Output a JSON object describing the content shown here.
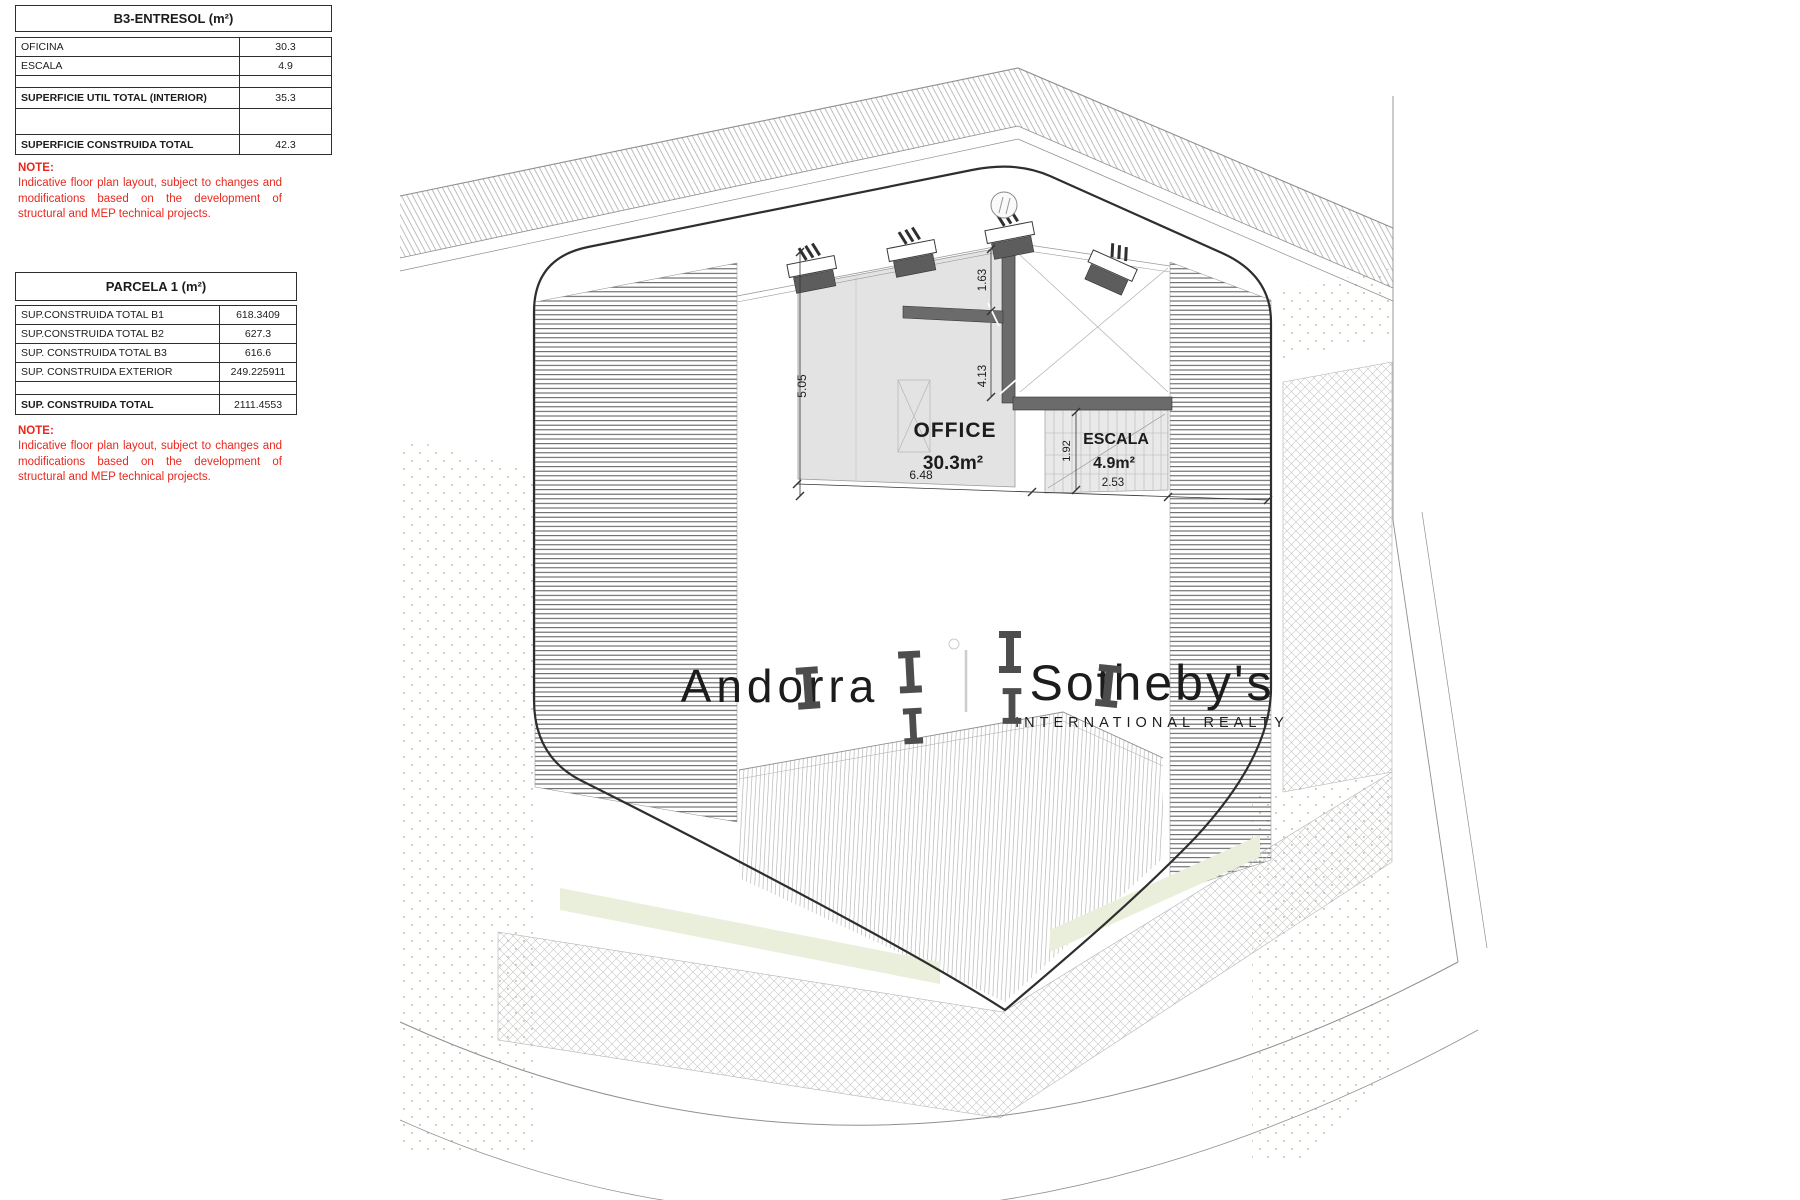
{
  "tables": {
    "b3_entresol": {
      "title": "B3-ENTRESOL (m²)",
      "rows": [
        {
          "label": "OFICINA",
          "value": "30.3"
        },
        {
          "label": "ESCALA",
          "value": "4.9"
        },
        {
          "label": "",
          "value": ""
        },
        {
          "label": "SUPERFICIE UTIL TOTAL (INTERIOR)",
          "value": "35.3"
        },
        {
          "label": "",
          "value": ""
        },
        {
          "label": "SUPERFICIE CONSTRUIDA TOTAL",
          "value": "42.3"
        }
      ]
    },
    "parcela1": {
      "title": "PARCELA 1 (m²)",
      "rows": [
        {
          "label": "SUP.CONSTRUIDA TOTAL B1",
          "value": "618.3409"
        },
        {
          "label": "SUP.CONSTRUIDA TOTAL B2",
          "value": "627.3"
        },
        {
          "label": "SUP. CONSTRUIDA TOTAL B3",
          "value": "616.6"
        },
        {
          "label": "SUP. CONSTRUIDA EXTERIOR",
          "value": "249.225911"
        },
        {
          "label": "",
          "value": ""
        },
        {
          "label": "SUP. CONSTRUIDA TOTAL",
          "value": "2111.4553"
        }
      ]
    }
  },
  "notes": {
    "label": "NOTE:",
    "text": "Indicative floor plan layout, subject to changes and modifications based on the development of structural and MEP technical projects."
  },
  "plan": {
    "rooms": [
      {
        "name": "OFFICE",
        "area": "30.3m²"
      },
      {
        "name": "ESCALA",
        "area": "4.9m²"
      }
    ],
    "dimensions": {
      "office_width": "6.48",
      "office_height": "5.05",
      "escala_width": "2.53",
      "escala_height": "1.92",
      "wall_upper": "1.63",
      "wall_lower": "4.13"
    },
    "watermark": {
      "part1": "Andorra",
      "part2": "Sotheby's",
      "subtitle": "INTERNATIONAL REALTY"
    }
  },
  "colors": {
    "note_red": "#e8281e",
    "office_fill": "#e3e3e3",
    "wall_gray": "#6b6b6b",
    "watermark_gray": "#c8c8c8",
    "dot_beige": "#cfc49e"
  }
}
